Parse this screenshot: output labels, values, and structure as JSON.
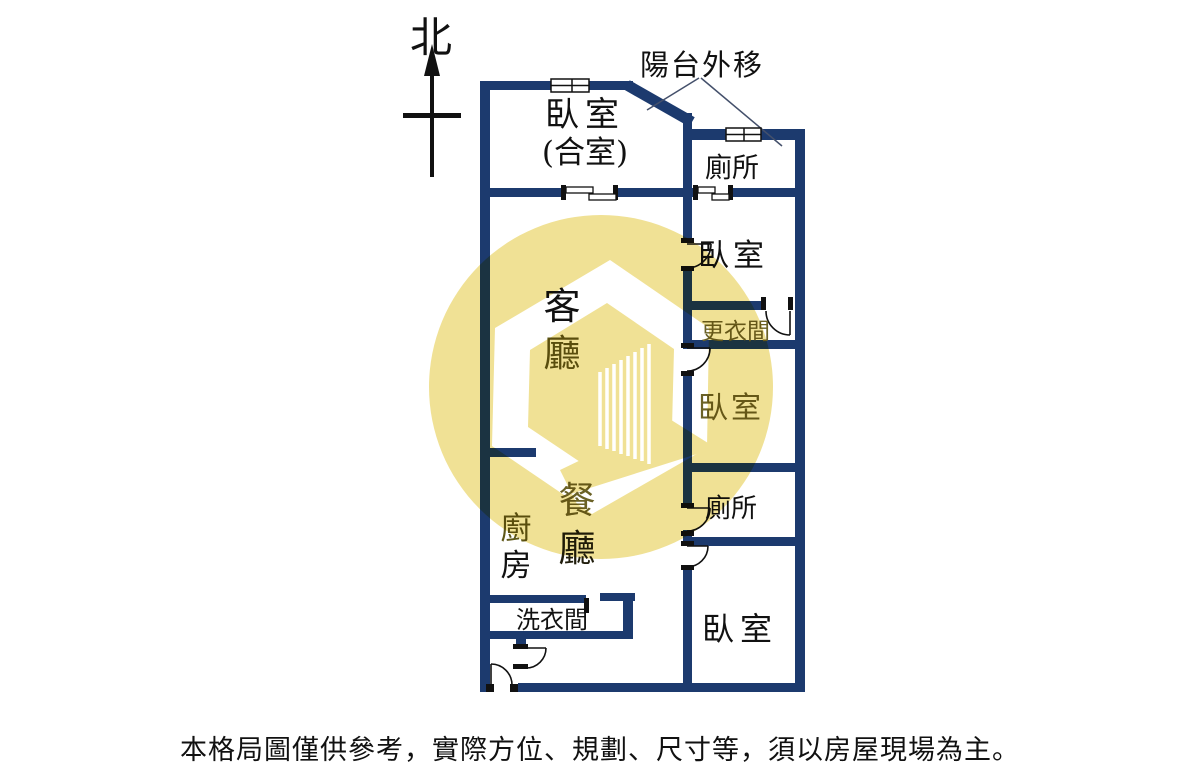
{
  "north_label": "北",
  "annotation": {
    "balcony_note": "陽台外移"
  },
  "rooms": {
    "bedroom_top": {
      "line1": "臥室",
      "line2": "(合室)"
    },
    "toilet_top": "廁所",
    "bedroom_right1": "臥室",
    "closet": "更衣間",
    "bedroom_right2": "臥室",
    "living": {
      "char1": "客",
      "char2": "廳"
    },
    "toilet_lower": "廁所",
    "dining": {
      "char1": "餐",
      "char2": "廳"
    },
    "kitchen": {
      "char1": "廚",
      "char2": "房"
    },
    "laundry": "洗衣間",
    "bedroom_bottom": "臥室"
  },
  "disclaimer": "本格局圖僅供參考，實際方位、規劃、尺寸等，須以房屋現場為主。",
  "colors": {
    "wall": "#1c3a6e",
    "text": "#111111",
    "highlight_text": "#6b6226",
    "watermark_yellow": "#f0e195",
    "watermark_logo": "#ffffff"
  }
}
